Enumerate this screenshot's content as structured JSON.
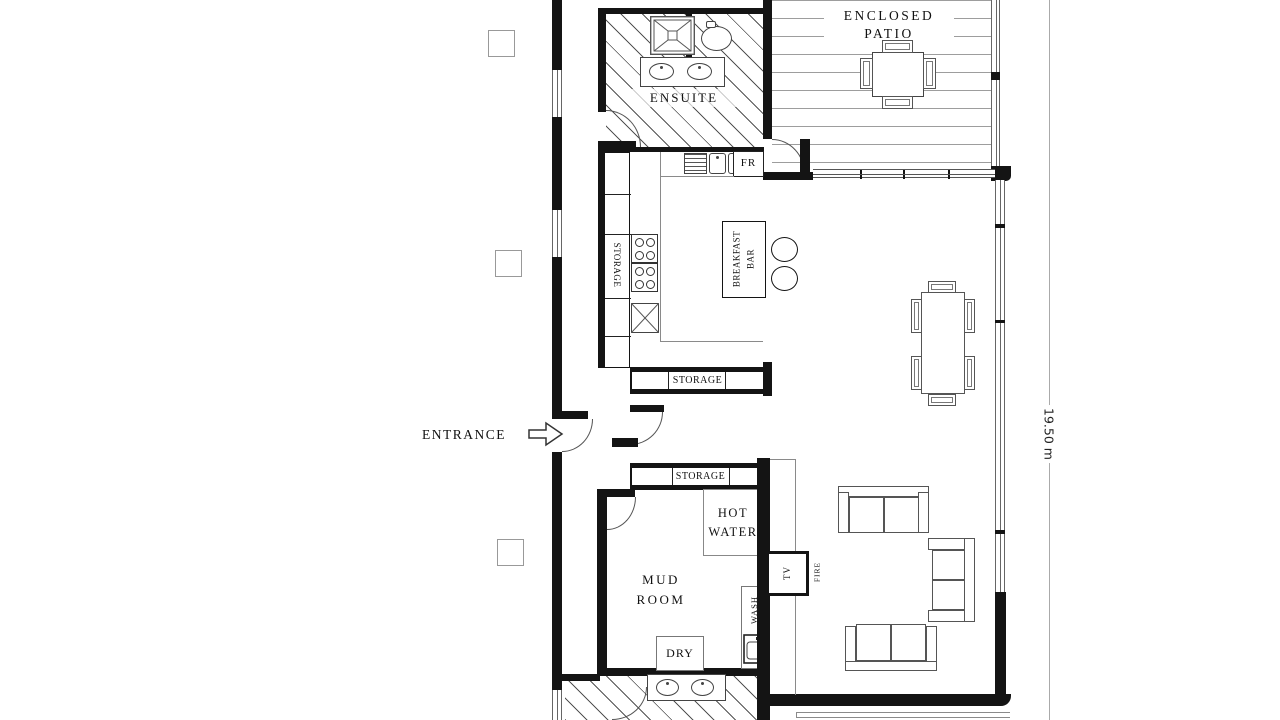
{
  "labels": {
    "ensuite": "ENSUITE",
    "enclosed_patio_1": "ENCLOSED",
    "enclosed_patio_2": "PATIO",
    "kitchen_pantry": "STORAGE",
    "fridge": "FR",
    "breakfast_bar_1": "BREAKFAST",
    "breakfast_bar_2": "BAR",
    "hall_storage_top": "STORAGE",
    "hall_storage_bottom": "STORAGE",
    "entrance": "ENTRANCE",
    "hot_water_1": "HOT",
    "hot_water_2": "WATER",
    "mud_room_1": "MUD",
    "mud_room_2": "ROOM",
    "tv": "TV",
    "fire": "FIRE",
    "wash": "WASH",
    "dry": "DRY",
    "dimension_height": "19.50 m"
  },
  "colors": {
    "wall": "#141414",
    "thin_line": "#777777",
    "text": "#111111",
    "dimension_line": "#aaaaaa",
    "background": "#ffffff"
  }
}
